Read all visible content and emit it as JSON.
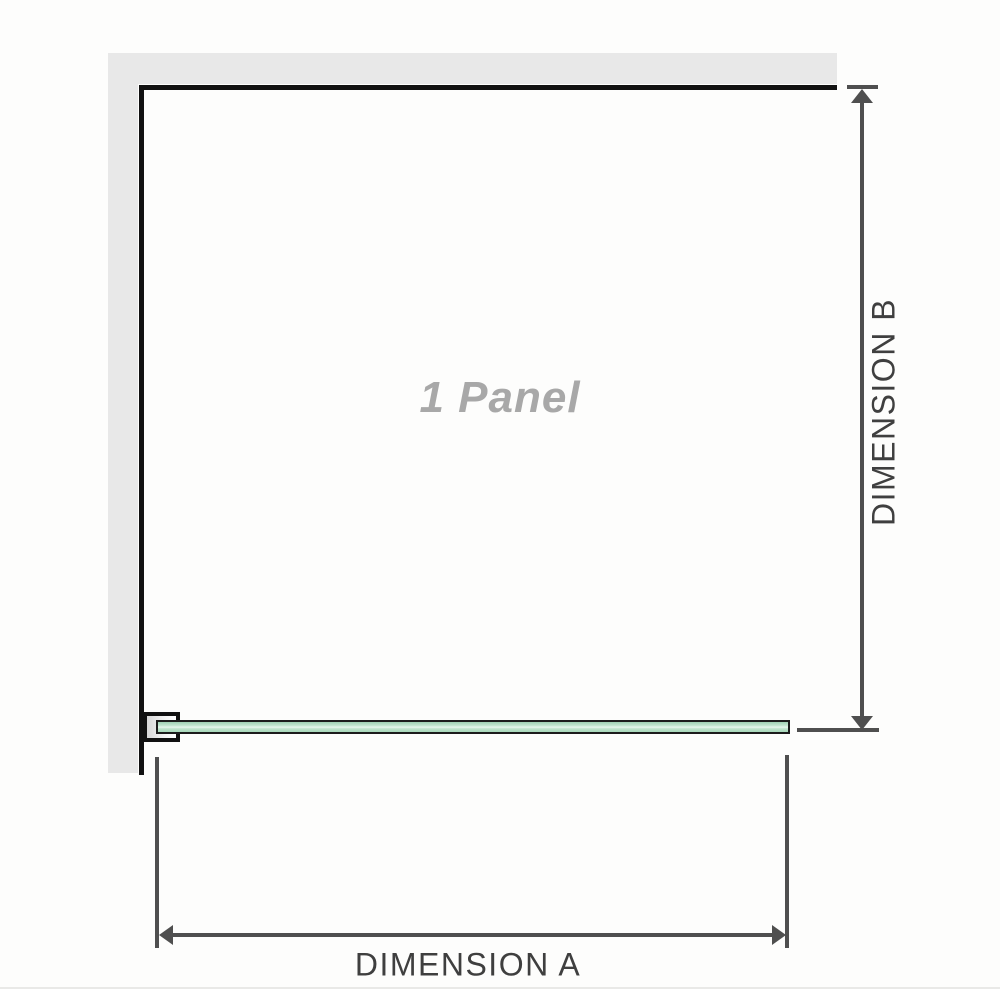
{
  "diagram": {
    "panel_label": "1 Panel",
    "dimension_a": {
      "label": "DIMENSION A"
    },
    "dimension_b": {
      "label": "DIMENSION B"
    }
  },
  "colors": {
    "wall_fill": "#e8e8e8",
    "outline": "#111111",
    "glass_border": "#1c1c1c",
    "glass_green": "#a6d8ba",
    "glass_green_light": "#e7f7ed",
    "dimension_gray": "#4f4f4f",
    "dimension_label_text": "#3f3f3f",
    "panel_label_text": "#a8a8a8",
    "baseline_strip": "#e9e9e7"
  }
}
